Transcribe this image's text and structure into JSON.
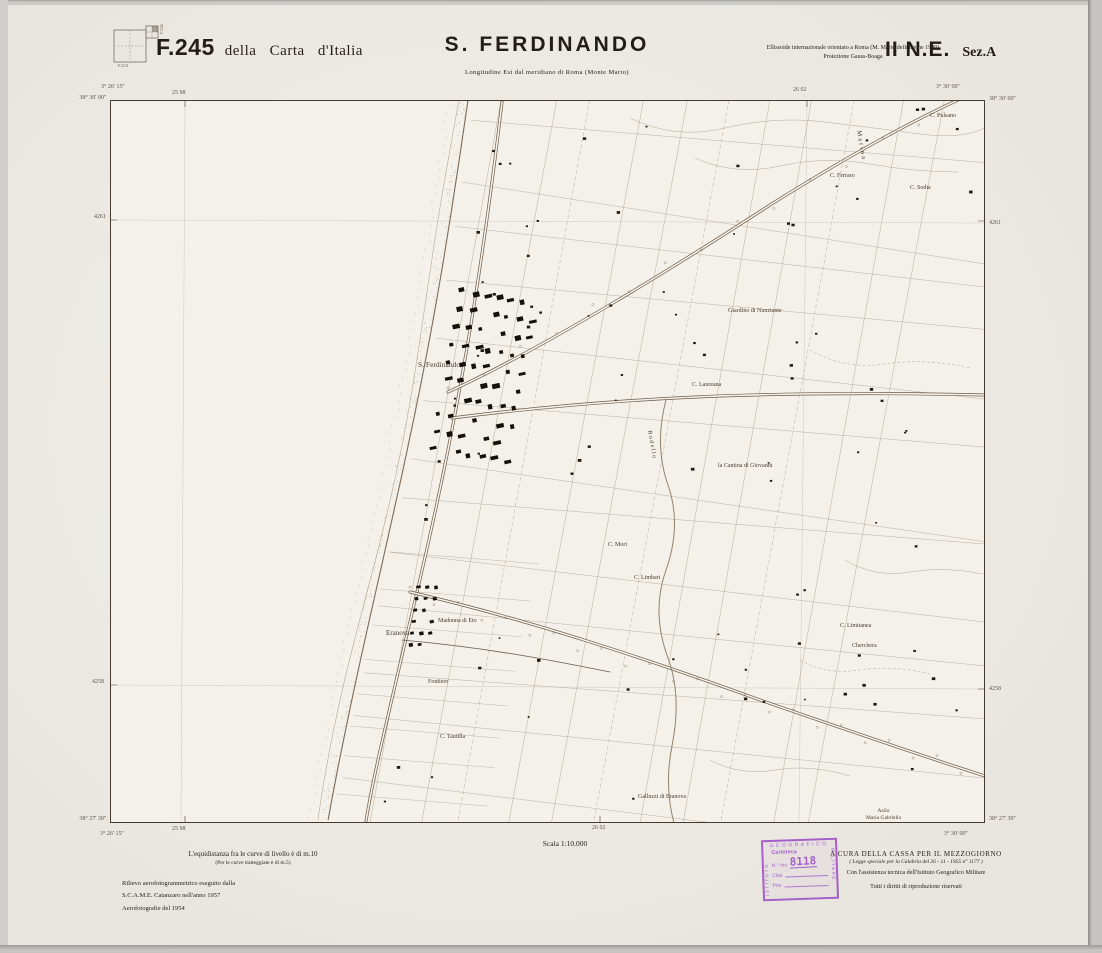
{
  "header": {
    "index": {
      "bottom_label": "F.254",
      "side_label": "F.246"
    },
    "sheet_number": "F.245",
    "sheet_series": "della Carta d'Italia",
    "title": "S. FERDINANDO",
    "subtitle": "Longitudine Est dal meridiano di Roma (Monte Mario)",
    "projection_line1": "Ellissoide internazionale orientato a Roma (M. Mario definizione 1940)",
    "projection_line2": "Proiezione Gauss-Boaga",
    "quadrant": "II N.E.",
    "section": "Sez.A"
  },
  "map_frame": {
    "edge": {
      "tl_lon": "3° 26' 15''",
      "tl_lat": "38° 30' 00''",
      "tr_lon": "3° 30' 00''",
      "tr_lat": "38° 30' 00''",
      "bl_lat": "38° 27' 30''",
      "bl_lon": "3° 26' 15''",
      "br_lat": "38° 27' 30''",
      "br_lon": "3° 30' 00''",
      "grid_top_left": "25 98",
      "grid_top_right": "26 02",
      "grid_bottom_left": "25 98",
      "grid_bottom_right": "26 02",
      "northing_upper": "4261",
      "northing_lower": "4258"
    },
    "place_labels": [
      {
        "text": "S. Ferdinando",
        "x": 308,
        "y": 260,
        "size": 7.5
      },
      {
        "text": "Eranova",
        "x": 276,
        "y": 529,
        "size": 7
      },
      {
        "text": "Marina",
        "x": 752,
        "y": 30,
        "size": 6.5,
        "rot": 80,
        "ls": 2
      },
      {
        "text": "C. Pulsano",
        "x": 820,
        "y": 13,
        "size": 6
      },
      {
        "text": "C. Ferraro",
        "x": 720,
        "y": 73,
        "size": 6
      },
      {
        "text": "C. Sodia",
        "x": 800,
        "y": 85,
        "size": 6
      },
      {
        "text": "Giardino di Nunziante",
        "x": 618,
        "y": 208,
        "size": 6
      },
      {
        "text": "C. Laureana",
        "x": 582,
        "y": 282,
        "size": 6
      },
      {
        "text": "la Cantina di Giovanni",
        "x": 608,
        "y": 363,
        "size": 6
      },
      {
        "text": "C. Mori",
        "x": 498,
        "y": 442,
        "size": 6
      },
      {
        "text": "C. Limbari",
        "x": 524,
        "y": 475,
        "size": 6
      },
      {
        "text": "C. Limitanea",
        "x": 730,
        "y": 523,
        "size": 6
      },
      {
        "text": "Cherchera",
        "x": 742,
        "y": 543,
        "size": 6
      },
      {
        "text": "Madonna di Eto",
        "x": 328,
        "y": 518,
        "size": 6
      },
      {
        "text": "Fontiero",
        "x": 318,
        "y": 579,
        "size": 6
      },
      {
        "text": "C. Tautilla",
        "x": 330,
        "y": 634,
        "size": 6
      },
      {
        "text": "Galluzzi di Eranova",
        "x": 528,
        "y": 694,
        "size": 6
      },
      {
        "text": "Asilo\nMaria Gabriella",
        "x": 756,
        "y": 708,
        "size": 5.5,
        "pre": true
      },
      {
        "text": "B u d e l l o",
        "x": 542,
        "y": 330,
        "size": 6,
        "rot": 80
      }
    ]
  },
  "footer": {
    "equidistance_line1": "L'equidistanza fra le curve di livello è di m.10",
    "equidistance_line2": "(Per le curve tratteggiate è di m.5)",
    "survey_line1": "Rilievo aerofotogrammetrico eseguito dalla",
    "survey_line2": "S.C.A.M.E.  Catanzaro  nell'anno  1957",
    "survey_line3": "Aerofotografie del 1954",
    "scale_label": "Scala 1:10.000",
    "credit_line1": "A CURA DELLA CASSA PER IL MEZZOGIORNO",
    "credit_line2": "( Legge speciale per la Calabria del 26 - 11 - 1955 n° 1177 )",
    "credit_line3": "Con l'assistenza tecnica dell'Istituto Geografico Militare",
    "credit_line4": "Tutti i diritti di riproduzione riservati"
  },
  "stamp": {
    "top": "GEOGRAFICO",
    "left": "ISTITUTO",
    "right": "MILITARE",
    "line1": "Cartoteca",
    "inv_label": "N.° Inv.",
    "inv_number": "8118",
    "clas_label": "Clas.",
    "pos_label": "Pos."
  },
  "colors": {
    "paper": "#efece5",
    "map_bg": "#f4f1ea",
    "sepia_line": "#a5967f",
    "road": "#6b5a47",
    "ink": "#241d15",
    "stamp_purple": "#a55fca"
  }
}
